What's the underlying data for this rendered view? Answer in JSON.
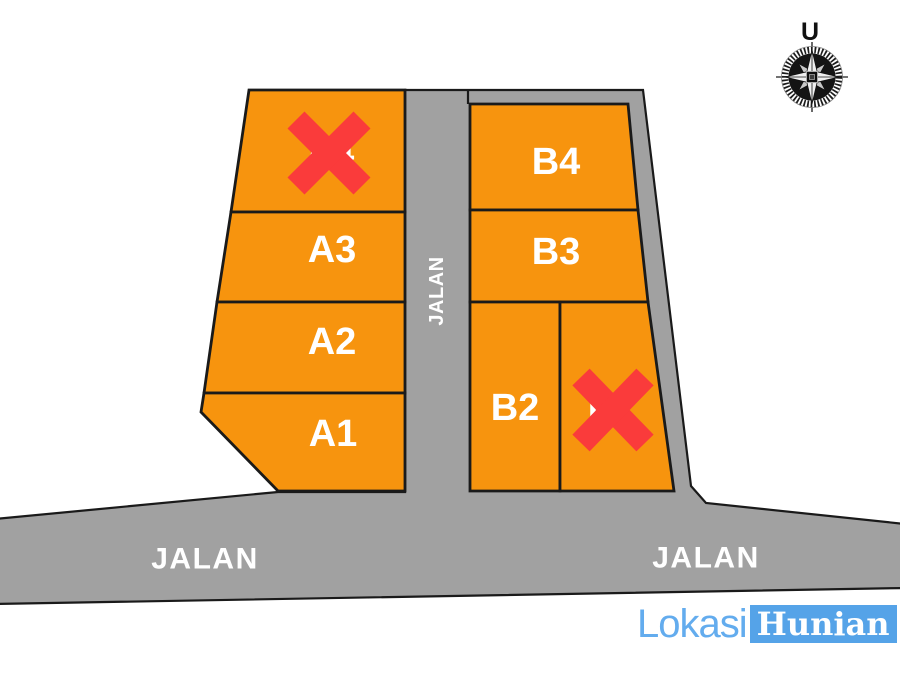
{
  "compass": {
    "north_label": "U"
  },
  "roads": {
    "vertical_road_label": "JALAN",
    "bottom_road_left_label": "JALAN",
    "bottom_road_right_label": "JALAN"
  },
  "lots": {
    "a4": {
      "label": "A4",
      "crossed_out": true
    },
    "a3": {
      "label": "A3",
      "crossed_out": false
    },
    "a2": {
      "label": "A2",
      "crossed_out": false
    },
    "a1": {
      "label": "A1",
      "crossed_out": false
    },
    "b4": {
      "label": "B4",
      "crossed_out": false
    },
    "b3": {
      "label": "B3",
      "crossed_out": false
    },
    "b2": {
      "label": "B2",
      "crossed_out": false
    },
    "b1": {
      "label": "B1",
      "crossed_out": true
    }
  },
  "logo": {
    "text_primary": "Lokasi",
    "text_secondary": "Hunian"
  },
  "colors": {
    "lot_fill": "#F7940E",
    "road_fill": "#A1A1A1",
    "outline": "#1A1A1A",
    "sold_x": "#FA3B3B",
    "logo_blue": "#55A3E8",
    "label_white": "#FFFFFF"
  }
}
